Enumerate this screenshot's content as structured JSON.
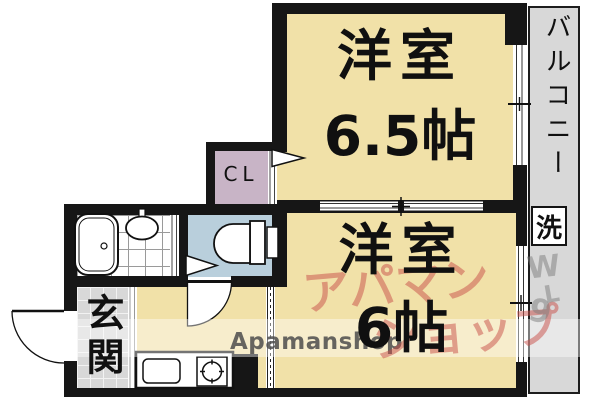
{
  "plan": {
    "room1": {
      "name": "洋室",
      "size": "6.5帖"
    },
    "room2": {
      "name": "洋室",
      "size": "6帖"
    },
    "closet_label": "CL",
    "entrance_label": "玄関",
    "balcony_label": "バルコニー",
    "laundry_label": "洗"
  },
  "watermark": {
    "latin": "Apamanshop",
    "katakana_line1": "アパマン",
    "katakana_line2": "ショップ",
    "frag1": "W",
    "frag2": "L",
    "frag3": "9"
  },
  "colors": {
    "wall": "#161616",
    "room_fill": "#f1e1a8",
    "toilet_fill": "#b9cfdc",
    "closet_fill": "#c8b4c6",
    "gray_fill": "#d8d8d8",
    "watermark_red": "#c94f49",
    "watermark_gray": "#4d4d4d"
  }
}
